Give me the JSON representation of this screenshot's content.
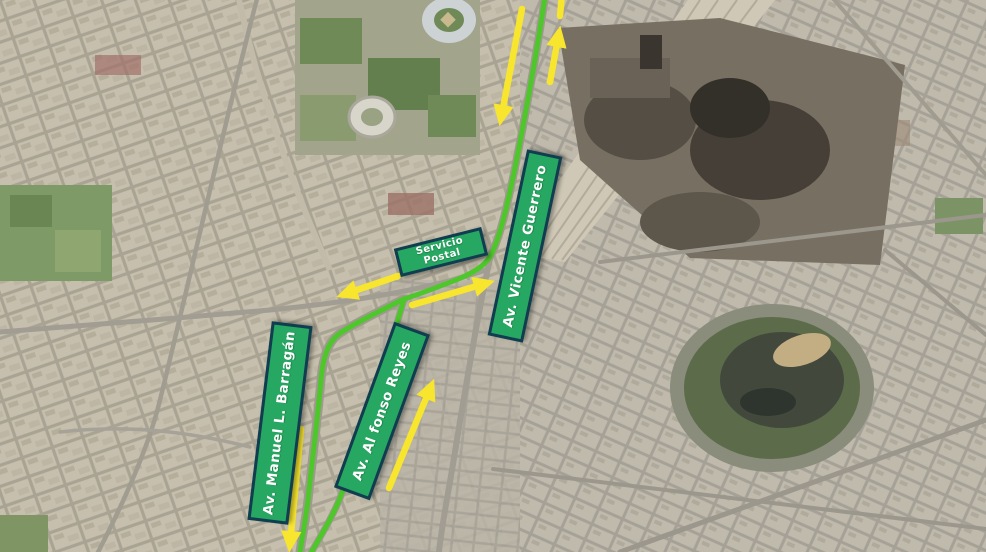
{
  "map": {
    "description": "Satellite city map with detour route overlay",
    "labels": {
      "servicio_postal": {
        "line1": "Servicio",
        "line2": "Postal"
      },
      "vicente_guerrero": "Av. Vicente Guerrero",
      "manuel_barragan": "Av. Manuel L. Barragán",
      "alfonso_reyes": "Av. Al fonso Reyes"
    },
    "arrows": [
      {
        "name": "southbound-arrow-top",
        "direction": "down"
      },
      {
        "name": "northbound-arrow-top",
        "direction": "up"
      },
      {
        "name": "westbound-arrow-center",
        "direction": "left"
      },
      {
        "name": "eastbound-arrow-center",
        "direction": "right"
      },
      {
        "name": "southbound-arrow-barragan",
        "direction": "down"
      },
      {
        "name": "northbound-arrow-alfonso",
        "direction": "up"
      }
    ],
    "colors": {
      "route": "#4ec72b",
      "arrow": "#f7e52e",
      "label_fill": "#27a862",
      "label_border": "#123c50",
      "label_text": "#ffffff"
    }
  }
}
